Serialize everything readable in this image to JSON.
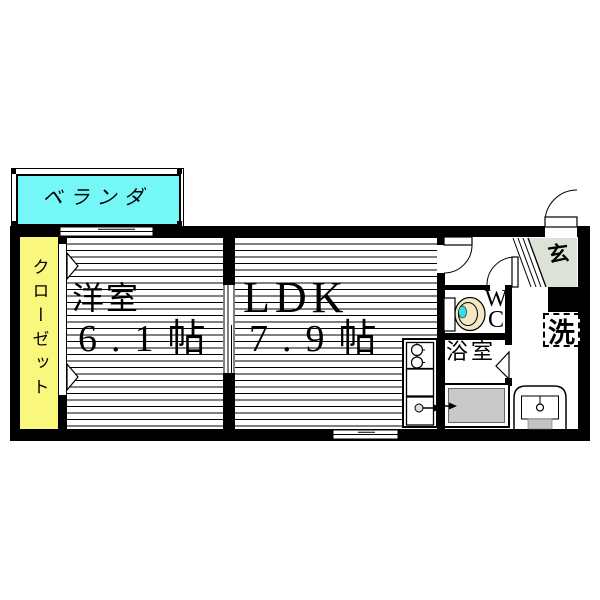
{
  "title": "apartment-floor-plan",
  "rooms": {
    "balcony": {
      "label": "ベランダ"
    },
    "closet": {
      "label": "クローゼット"
    },
    "western_room": {
      "name": "洋室",
      "size": "6.1帖"
    },
    "ldk": {
      "name": "LDK",
      "size": "7.9帖"
    },
    "wc": {
      "label": "WC"
    },
    "bathroom": {
      "label": "浴室"
    },
    "entrance": {
      "label": "玄"
    },
    "washer": {
      "label": "洗"
    }
  },
  "colors": {
    "balcony_fill": "#76F7F7",
    "closet_fill": "#F9F87D",
    "entrance_step_fill": "#DCE2D6",
    "bathtub_fill": "#C9C9C9",
    "toilet_fill": "#F2E8C6",
    "toilet_water": "#3ADEE0",
    "line": "#000000"
  }
}
